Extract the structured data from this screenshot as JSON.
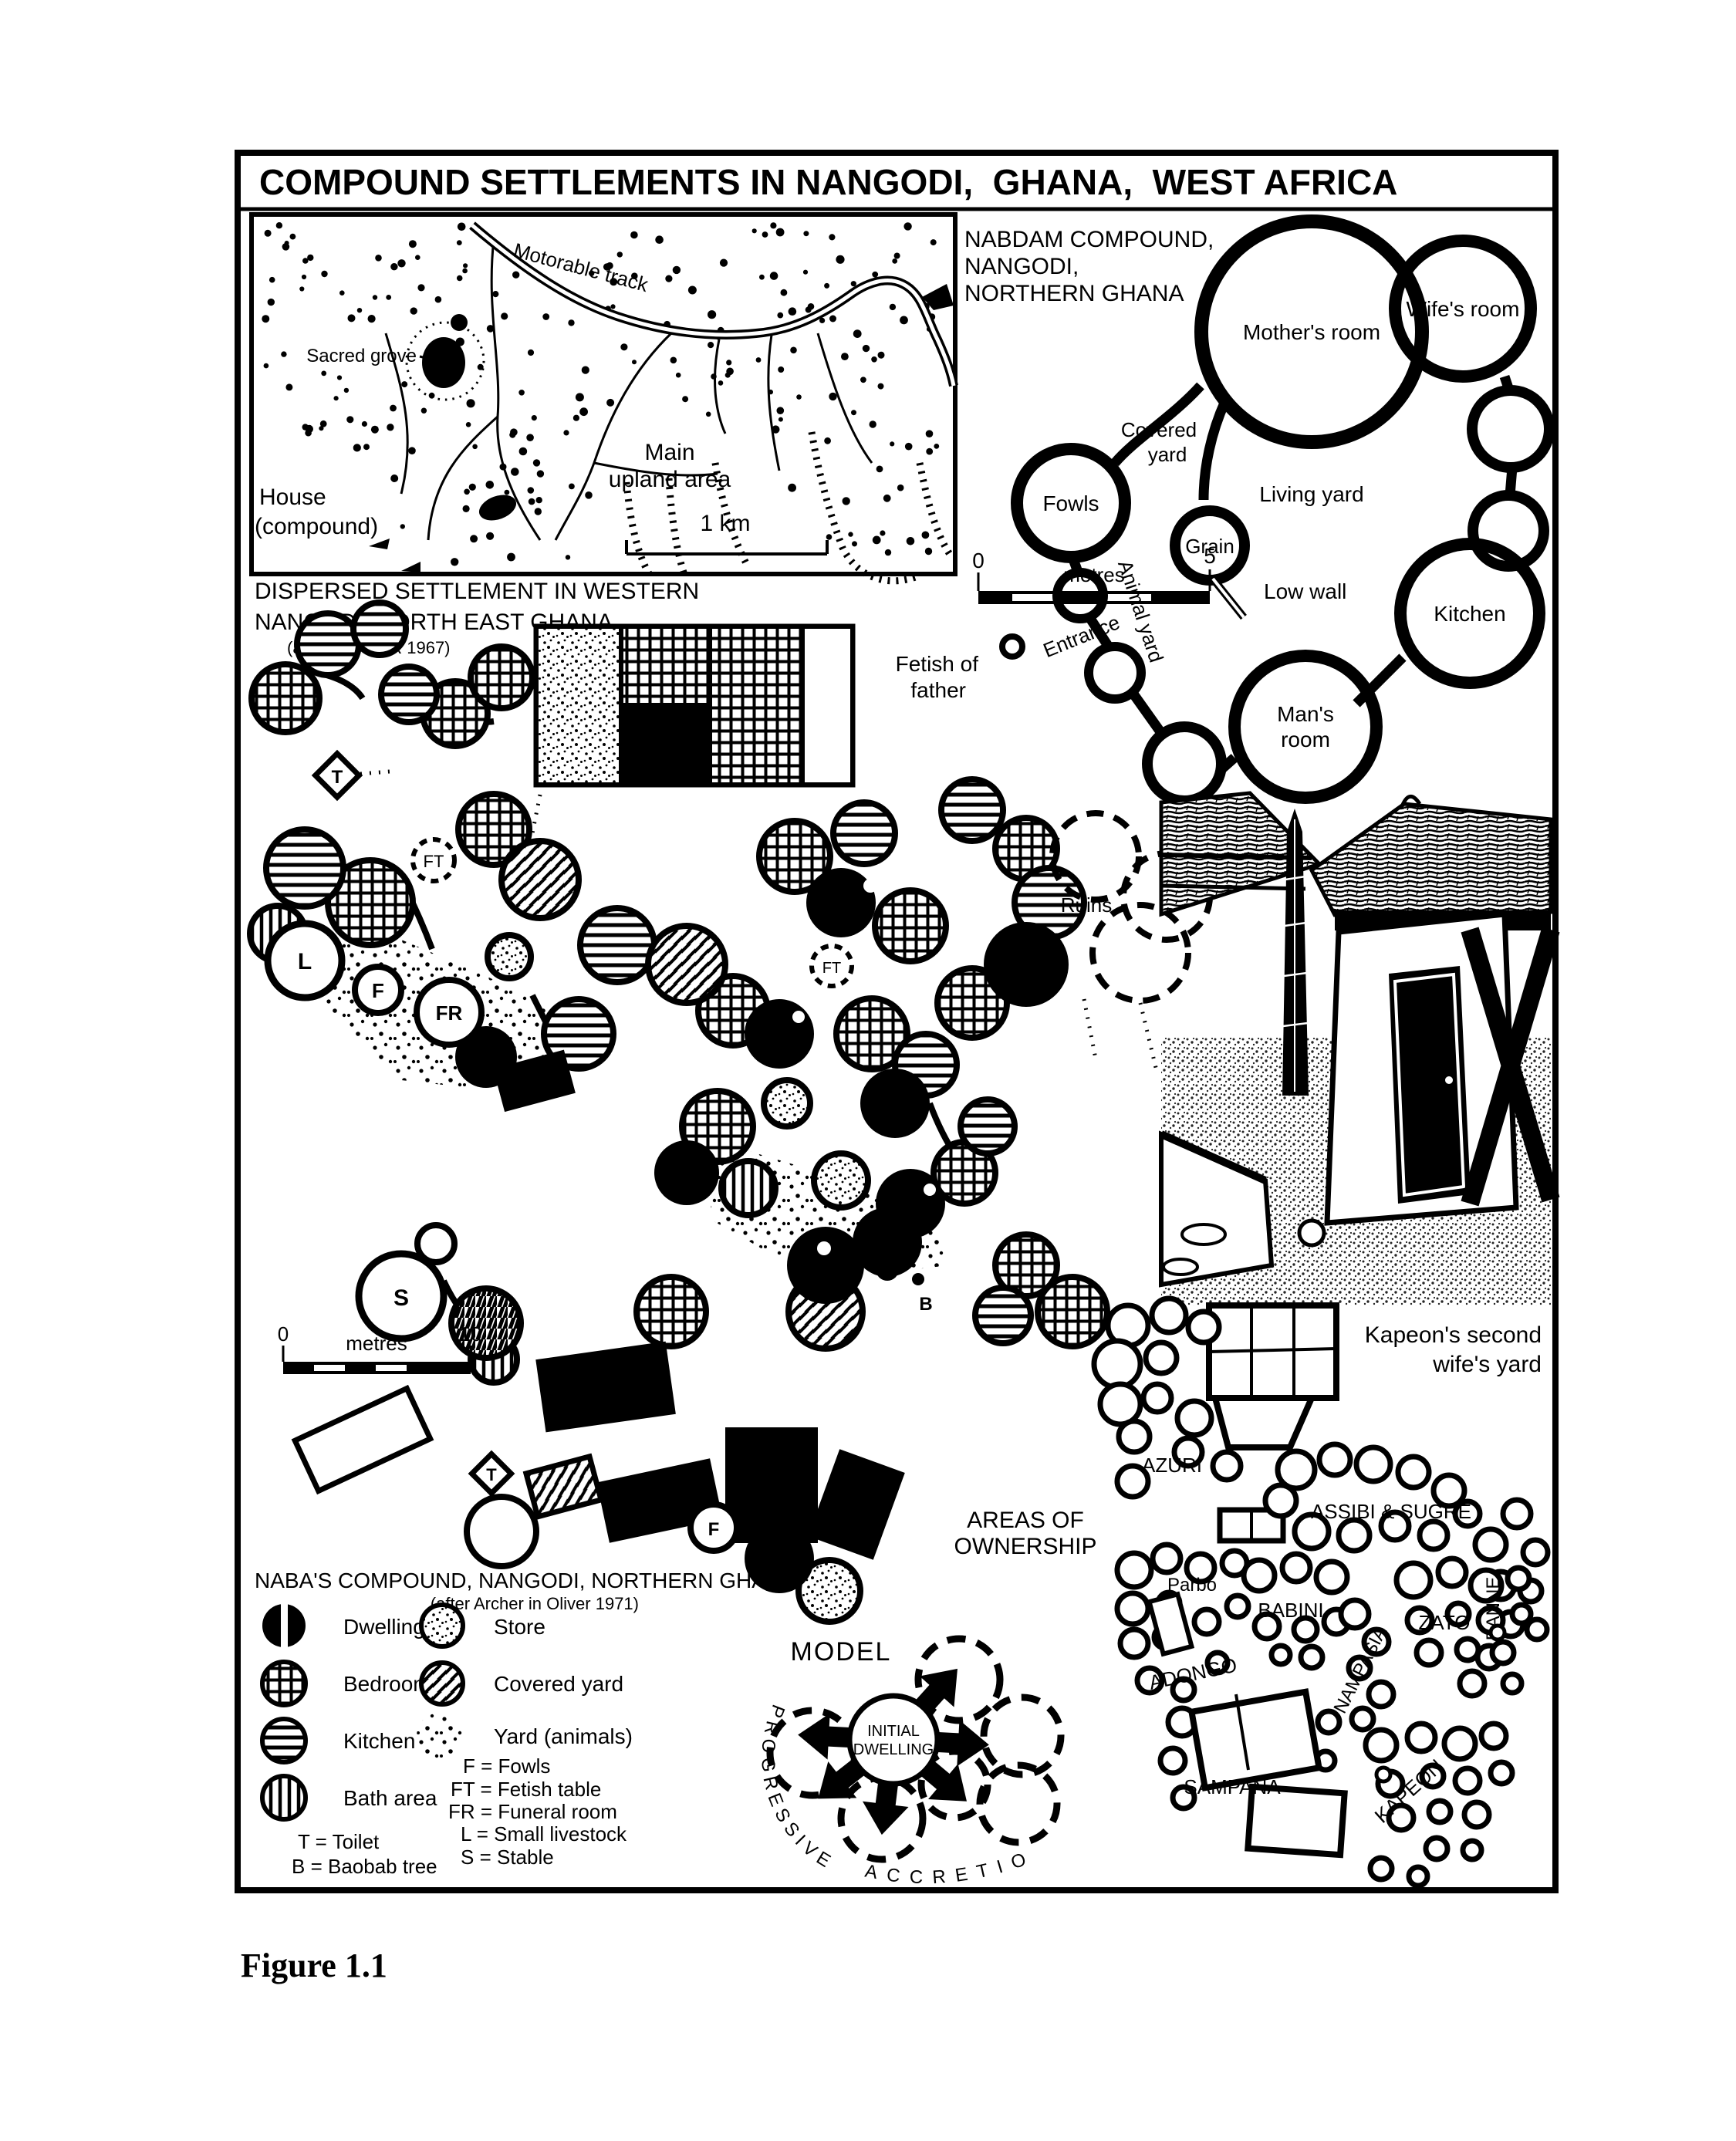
{
  "figure": {
    "title": "COMPOUND SETTLEMENTS IN NANGODI,  GHANA,  WEST AFRICA",
    "caption": "Figure 1.1"
  },
  "map": {
    "track_label": "Motorable track",
    "sacred_grove_label": "Sacred grove",
    "upland_line1": "Main",
    "upland_line2": "upland area",
    "scale_label": "1 km",
    "house_line1": "House",
    "house_line2": "(compound)",
    "caption_line1": "DISPERSED SETTLEMENT IN WESTERN",
    "caption_line2": "NANGODI, NORTH EAST GHANA",
    "caption_credit": "(after HUNTER 1967)"
  },
  "nabdam": {
    "heading_line1": "NABDAM COMPOUND,",
    "heading_line2": "NANGODI,",
    "heading_line3": "NORTHERN GHANA",
    "scale_zero": "0",
    "scale_unit": "metres",
    "scale_max": "5",
    "mothers_room": "Mother's room",
    "wifes_room": "Wife's room",
    "covered_line1": "Covered",
    "covered_line2": "yard",
    "fowls": "Fowls",
    "living_yard": "Living yard",
    "grain": "Grain",
    "low_wall": "Low wall",
    "kitchen": "Kitchen",
    "animal_yard": "Animal yard",
    "entrance": "Entrance",
    "mans_line1": "Man's",
    "mans_line2": "room",
    "fetish_line1": "Fetish of",
    "fetish_line2": "father"
  },
  "plan": {
    "ruins": "Ruins",
    "marker_t": "T",
    "marker_ft": "FT",
    "marker_l": "L",
    "marker_f": "F",
    "marker_fr": "FR",
    "marker_s": "S",
    "marker_b": "B",
    "scale_zero": "0",
    "scale_unit": "metres",
    "scale_max": "10",
    "areas_line1": "AREAS OF",
    "areas_line2": "OWNERSHIP"
  },
  "legend": {
    "heading": "NABA'S COMPOUND, NANGODI, NORTHERN GHANA",
    "credit": "(after Archer in Oliver 1971)",
    "items_left": [
      {
        "key": "dwelling",
        "label": "Dwelling"
      },
      {
        "key": "bedroom",
        "label": "Bedroom"
      },
      {
        "key": "kitchen",
        "label": "Kitchen"
      },
      {
        "key": "bath",
        "label": "Bath area"
      }
    ],
    "items_right": [
      {
        "key": "store",
        "label": "Store"
      },
      {
        "key": "covered-yard",
        "label": "Covered yard"
      },
      {
        "key": "yard-animals",
        "label": "Yard (animals)"
      }
    ],
    "abbr_right": [
      "F = Fowls",
      "FT = Fetish table",
      "FR = Funeral room",
      "L = Small livestock",
      "S = Stable"
    ],
    "abbr_left": [
      "T = Toilet",
      "B = Baobab tree"
    ]
  },
  "model": {
    "title": "MODEL",
    "center_line1": "INITIAL",
    "center_line2": "DWELLING",
    "arc_left": "PROGRESSIVE",
    "arc_bottom": "ACCRETION"
  },
  "ownership": {
    "note_line1": "Kapeon's second",
    "note_line2": "wife's yard",
    "azuri": "AZURI",
    "assibi": "ASSIBI & SUGRE",
    "banne": "BANNE",
    "parbo": "Parbo",
    "babini": "BABINI",
    "zato": "ZATO",
    "adongo": "ADONGO",
    "nampasia": "NAMPASIA",
    "sampana": "SAMPANA",
    "kapeon": "KAPEON"
  },
  "ink": "#000000",
  "paper": "#ffffff"
}
